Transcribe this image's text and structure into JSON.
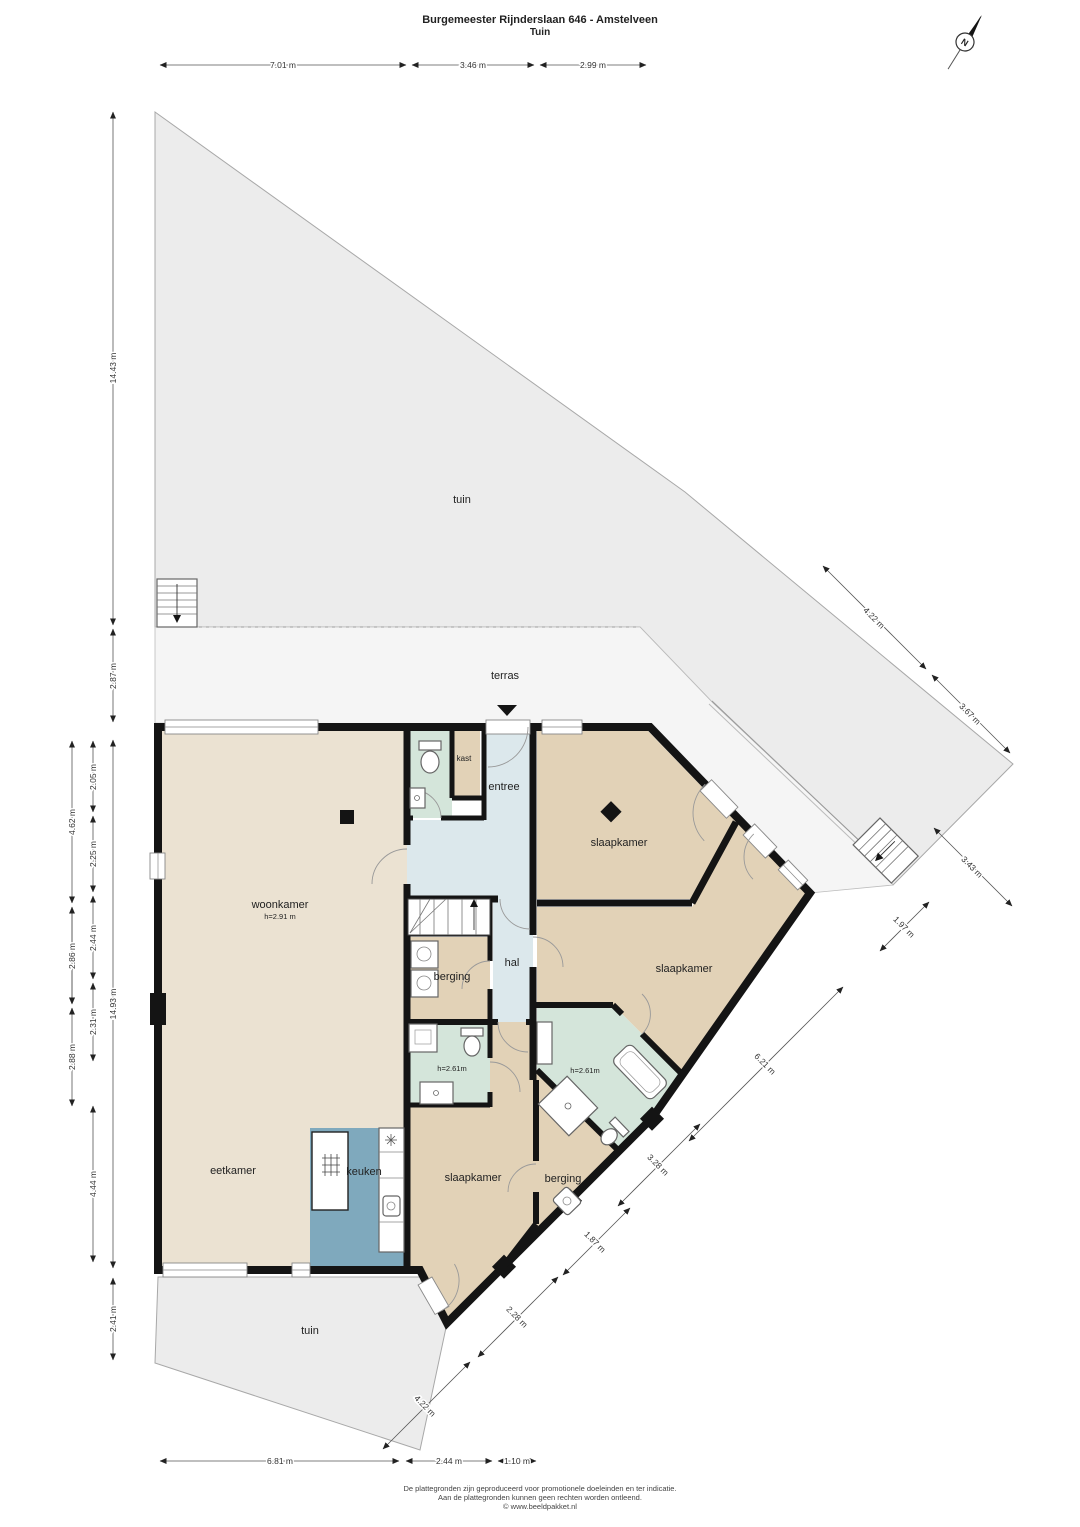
{
  "title": {
    "line1": "Burgemeester Rijnderslaan 646 - Amstelveen",
    "line2": "Tuin"
  },
  "compass": {
    "north_label": "N"
  },
  "areas": {
    "garden": "tuin",
    "terrace": "terras"
  },
  "rooms": {
    "living": "woonkamer",
    "living_height": "h=2.91 m",
    "dining": "eetkamer",
    "kitchen": "keuken",
    "closet": "kast",
    "entry": "entree",
    "hall": "hal",
    "storage": "berging",
    "bedroom": "slaapkamer",
    "bath_height": "h=2.61m"
  },
  "dimensions": {
    "top": [
      "7.01 m",
      "3.46 m",
      "2.99 m"
    ],
    "left_inner": [
      "14.43 m",
      "2.87 m",
      "14.93 m",
      "2.41 m"
    ],
    "left_middle": [
      "2.05 m",
      "2.25 m",
      "2.44 m",
      "2.31 m",
      "4.44 m"
    ],
    "left_outer": [
      "4.62 m",
      "2.86 m",
      "2.88 m"
    ],
    "right_diagonal": [
      "4.22 m",
      "3.67 m",
      "3.43 m",
      "1.97 m",
      "6.21 m",
      "3.28 m",
      "1.87 m",
      "2.28 m",
      "4.22 m"
    ],
    "bottom": [
      "6.81 m",
      "2.44 m",
      "1.10 m"
    ]
  },
  "footer": {
    "line1": "De plattegronden zijn geproduceerd voor promotionele doeleinden en ter indicatie.",
    "line2": "Aan de plattegronden kunnen geen rechten worden ontleend.",
    "line3": "© www.beeldpakket.nl"
  },
  "colors": {
    "wall": "#141414",
    "garden": "#ececec",
    "terrace": "#f5f5f5",
    "living_floor": "#ebe2d2",
    "bedroom_floor": "#e2d2b7",
    "bath_floor": "#d4e5da",
    "hall_floor": "#dce8ec",
    "kitchen_floor": "#7fa9bd"
  }
}
